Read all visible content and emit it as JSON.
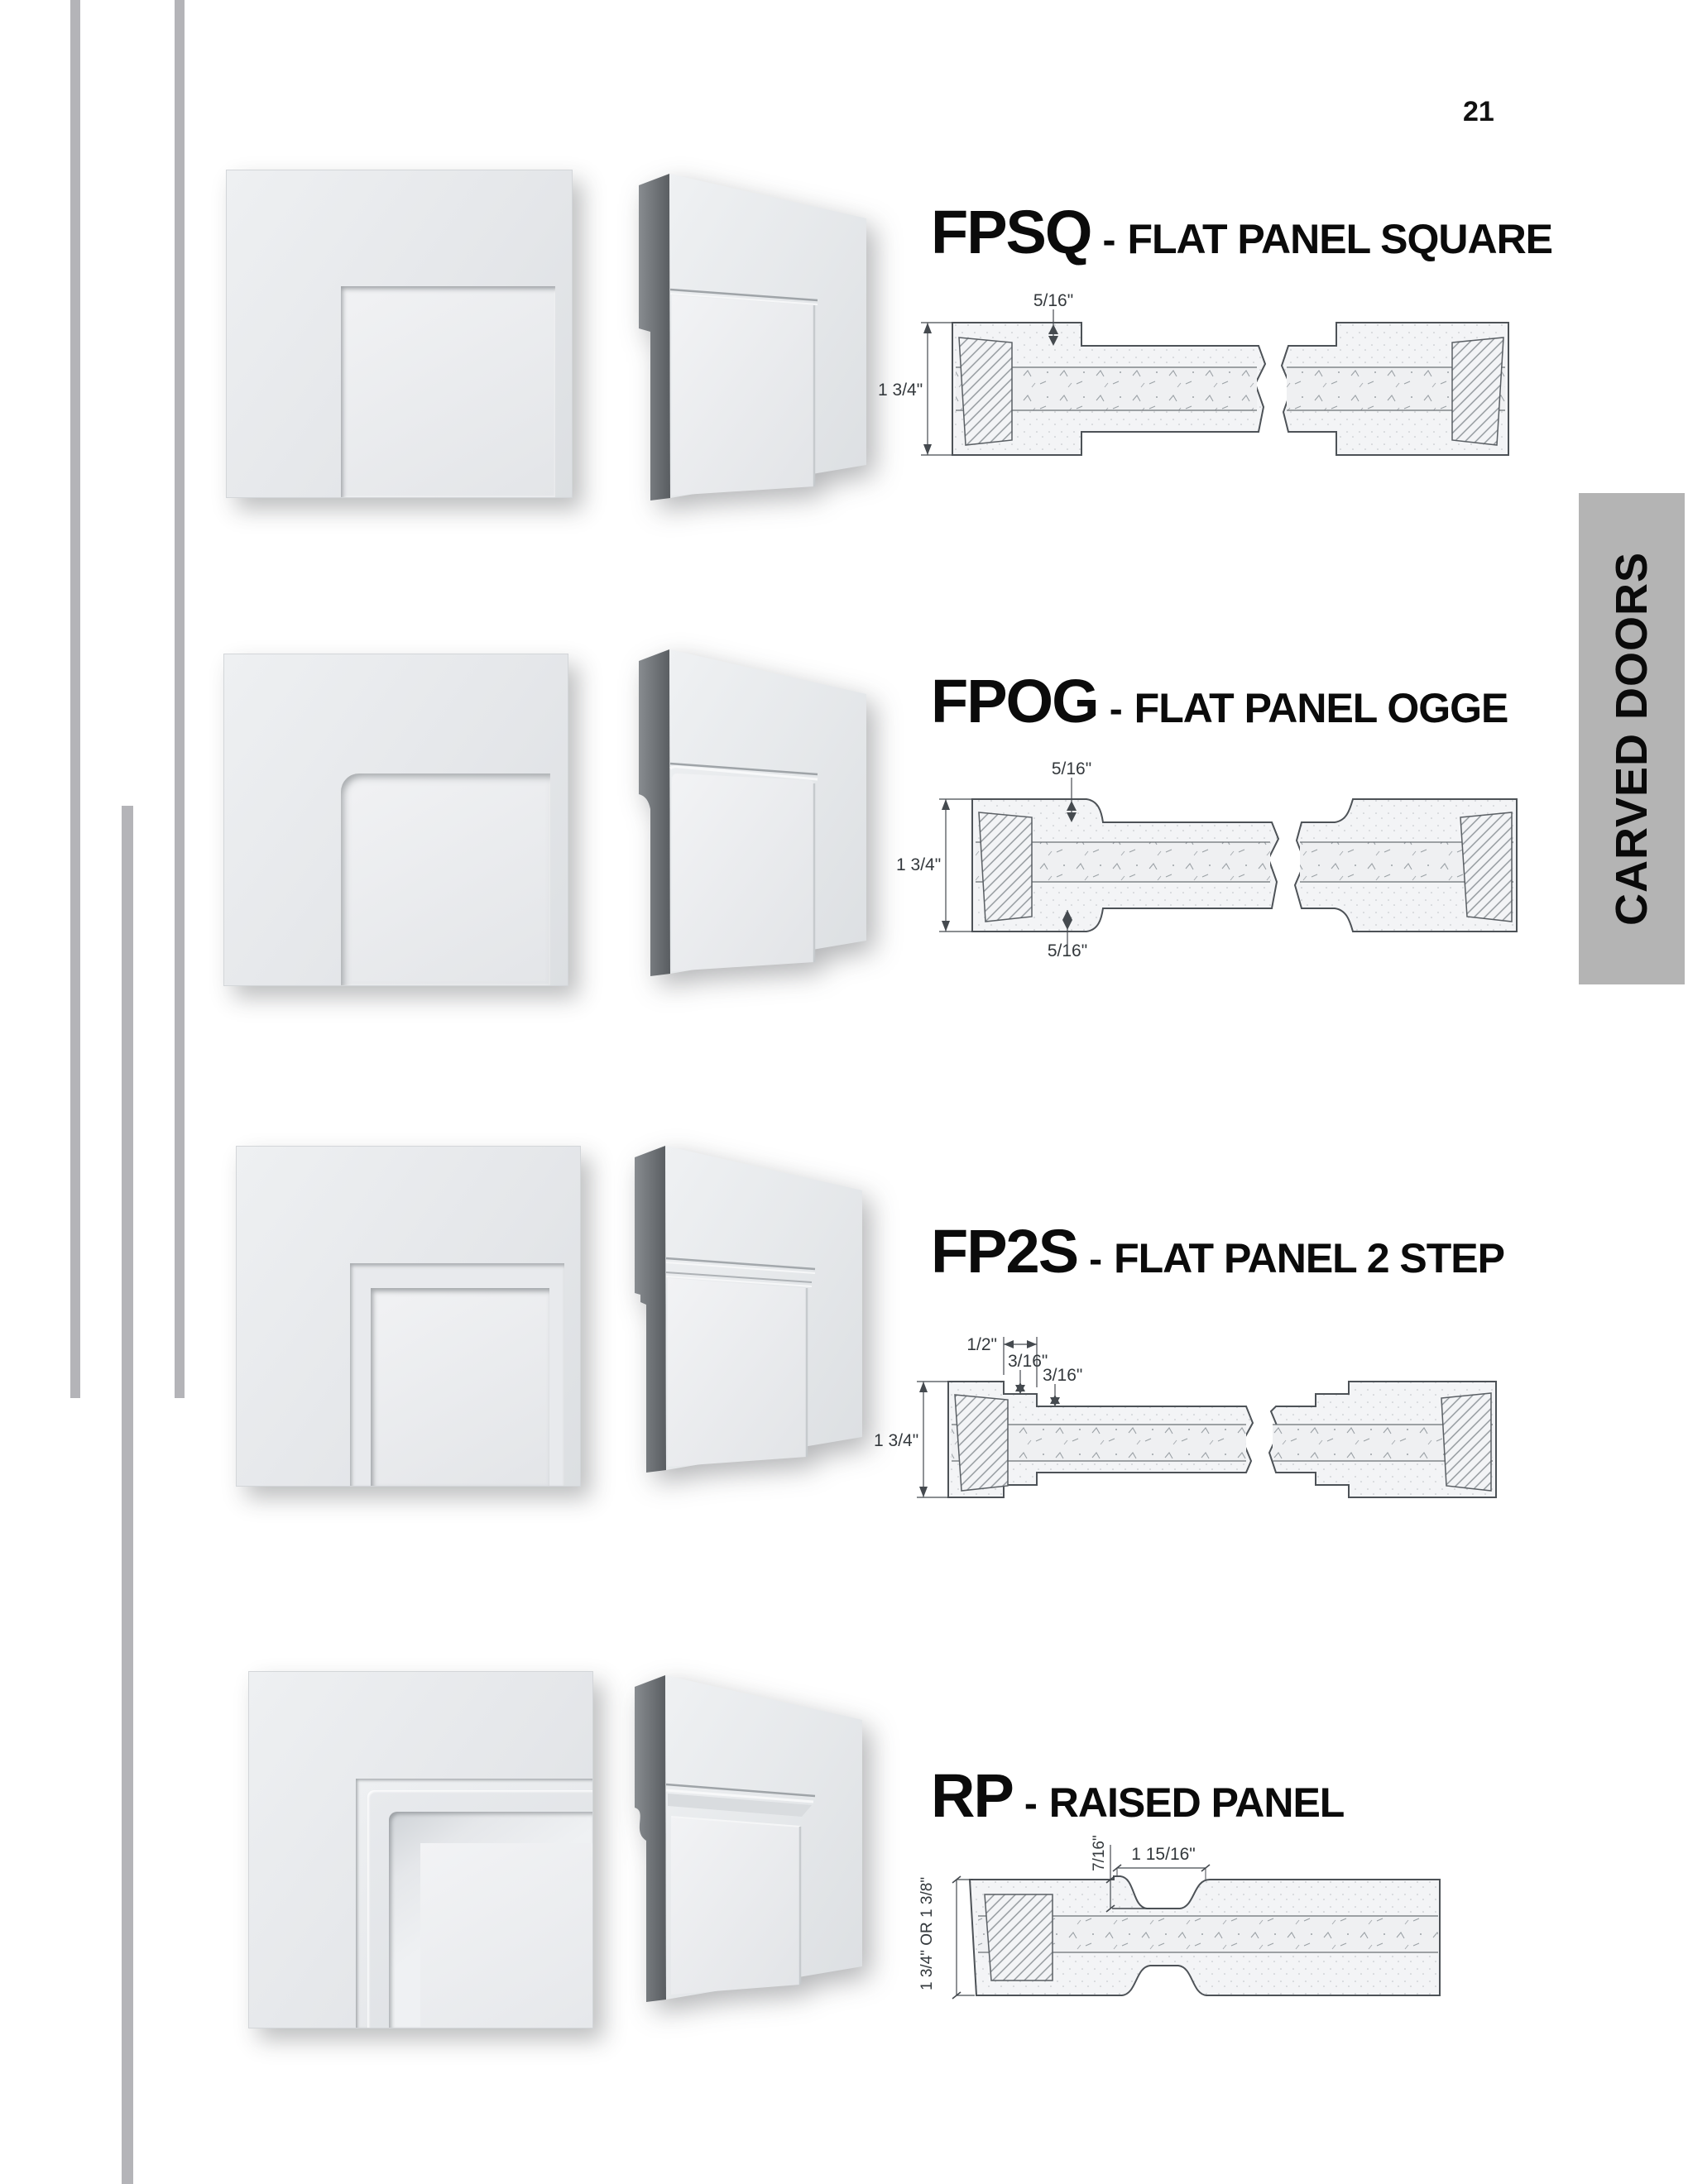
{
  "page": {
    "number": "21"
  },
  "sidebar": {
    "tab_label": "CARVED DOORS"
  },
  "colors": {
    "tab_bg": "#b4b4b4",
    "accent_line": "#b4b4b8",
    "title_text": "#0b0b0b",
    "drawing_line": "#4d5257"
  },
  "products": [
    {
      "code": "FPSQ",
      "sep": "-",
      "name": "FLAT PANEL SQUARE",
      "dims": {
        "thickness": "1 3/4\"",
        "panel_step": "5/16\""
      }
    },
    {
      "code": "FPOG",
      "sep": "-",
      "name": "FLAT PANEL OGGE",
      "dims": {
        "thickness": "1 3/4\"",
        "top_step": "5/16\"",
        "bottom_step": "5/16\""
      }
    },
    {
      "code": "FP2S",
      "sep": "-",
      "name": "FLAT PANEL 2 STEP",
      "dims": {
        "thickness": "1 3/4\"",
        "step_offset": "1/2\"",
        "step1": "3/16\"",
        "step2": "3/16\""
      }
    },
    {
      "code": "RP",
      "sep": "-",
      "name": "RAISED PANEL",
      "dims": {
        "thickness": "1 3/4\" OR 1 3/8\"",
        "cove_depth": "7/16\"",
        "panel_rise_width": "1 15/16\""
      }
    }
  ]
}
